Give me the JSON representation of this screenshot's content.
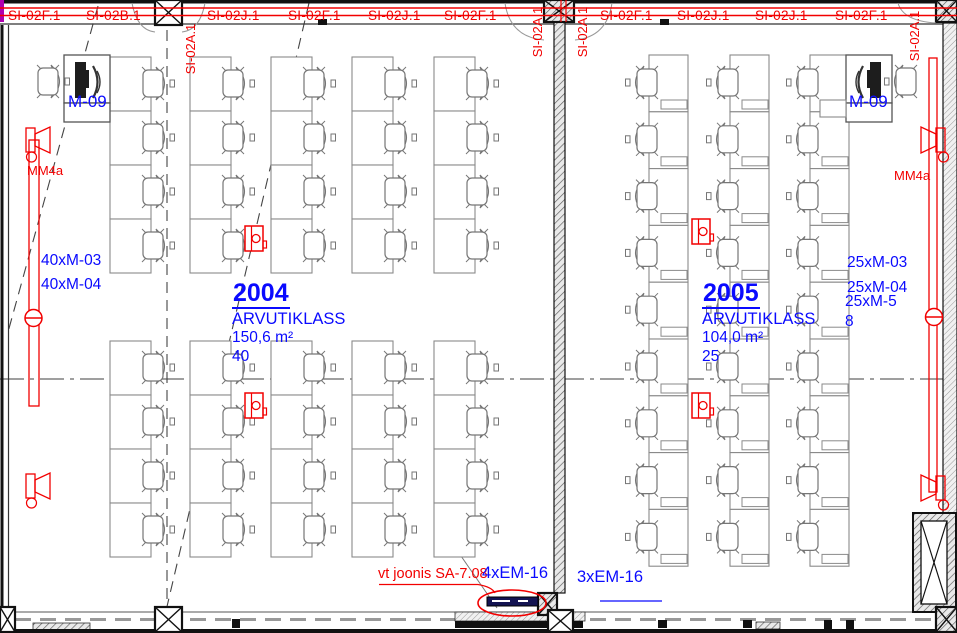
{
  "plan": {
    "colors": {
      "annotation_red": "#f20000",
      "annotation_blue": "#0a0aff"
    },
    "top_labels": [
      "SI-02F.1",
      "SI-02B.1",
      "SI-02J.1",
      "SI-02F.1",
      "SI-02J.1",
      "SI-02F.1",
      "SI-02F.1",
      "SI-02J.1",
      "SI-02J.1",
      "SI-02F.1"
    ],
    "vertical_labels": [
      "SI-02A.1",
      "SI-02A.1",
      "SI-02A.1",
      "SI-02A.1"
    ],
    "rooms": [
      {
        "number": "2004",
        "type": "ARVUTIKLASS",
        "area": "150,6 m²",
        "capacity": "40",
        "monitor_label": "M-09",
        "equipment_lines": [
          "40xM-03",
          "40xM-04"
        ]
      },
      {
        "number": "2005",
        "type": "ARVUTIKLASS",
        "area": "104,0 m²",
        "capacity": "25",
        "monitor_label": "M-09",
        "equipment_lines": [
          "25xM-03",
          "25xM-04",
          "25xM-5",
          "8"
        ]
      }
    ],
    "wall_labels": {
      "left": "MM4a",
      "right": "MM4a"
    },
    "callouts": {
      "drawing_reference": "vt joonis SA-7.08",
      "em_label_left": "4xEM-16",
      "em_label_right": "3xEM-16"
    }
  }
}
